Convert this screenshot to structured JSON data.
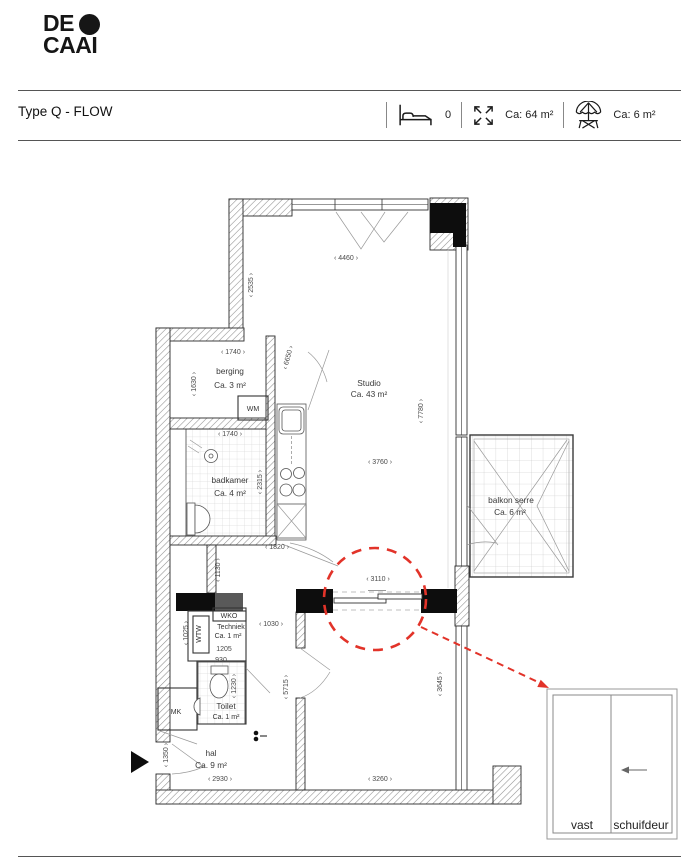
{
  "logo": {
    "line1": "DE",
    "line2": "CAAI"
  },
  "header": {
    "title": "Type Q - FLOW",
    "bedrooms": "0",
    "living_area": "Ca: 64 m²",
    "outdoor_area": "Ca: 6 m²",
    "icons": {
      "bed": "bed-icon",
      "expand": "expand-arrows-icon",
      "parasol": "parasol-icon"
    }
  },
  "plan": {
    "rooms": {
      "studio": {
        "name": "Studio",
        "area": "Ca. 43 m²"
      },
      "berging": {
        "name": "berging",
        "area": "Ca. 3 m²"
      },
      "badkamer": {
        "name": "badkamer",
        "area": "Ca. 4 m²"
      },
      "balkon": {
        "name": "balkon serre",
        "area": "Ca. 6 m²"
      },
      "techniek": {
        "name": "Techniek",
        "area": "Ca. 1 m²"
      },
      "toilet": {
        "name": "Toilet",
        "area": "Ca. 1 m²"
      },
      "hal": {
        "name": "hal",
        "area": "Ca. 9 m²"
      }
    },
    "appliances": {
      "wm": "WM",
      "wko": "WKO",
      "wtw": "WTW",
      "mk": "MK"
    },
    "dims": {
      "d4460": "‹ 4460 ›",
      "d2535": "‹ 2535 ›",
      "d1740_berging": "‹ 1740 ›",
      "d6650": "‹ 6650 ›",
      "d1630": "‹ 1630 ›",
      "d1740_badkamer": "‹ 1740 ›",
      "d2315": "‹ 2315 ›",
      "d3760": "‹ 3760 ›",
      "d7780": "‹ 7780 ›",
      "d1820": "‹ 1820 ›",
      "d1130": "‹ 1130 ›",
      "d3110": "‹ 3110 ›",
      "d1025": "‹ 1025 ›",
      "d1030": "‹ 1030 ›",
      "d1205": "1205",
      "d930": "930",
      "d1230": "‹ 1230 ›",
      "d5715": "‹ 5715 ›",
      "d3645": "‹ 3645 ›",
      "d1350": "‹ 1350 ›",
      "d2930": "‹ 2930 ›",
      "d3260": "‹ 3260 ›"
    },
    "legend": {
      "fixed": "vast",
      "sliding": "schuifdeur"
    },
    "colors": {
      "highlight_red": "#e23329",
      "wall_black": "#0d0d0d",
      "wall_gray": "#595959"
    }
  }
}
